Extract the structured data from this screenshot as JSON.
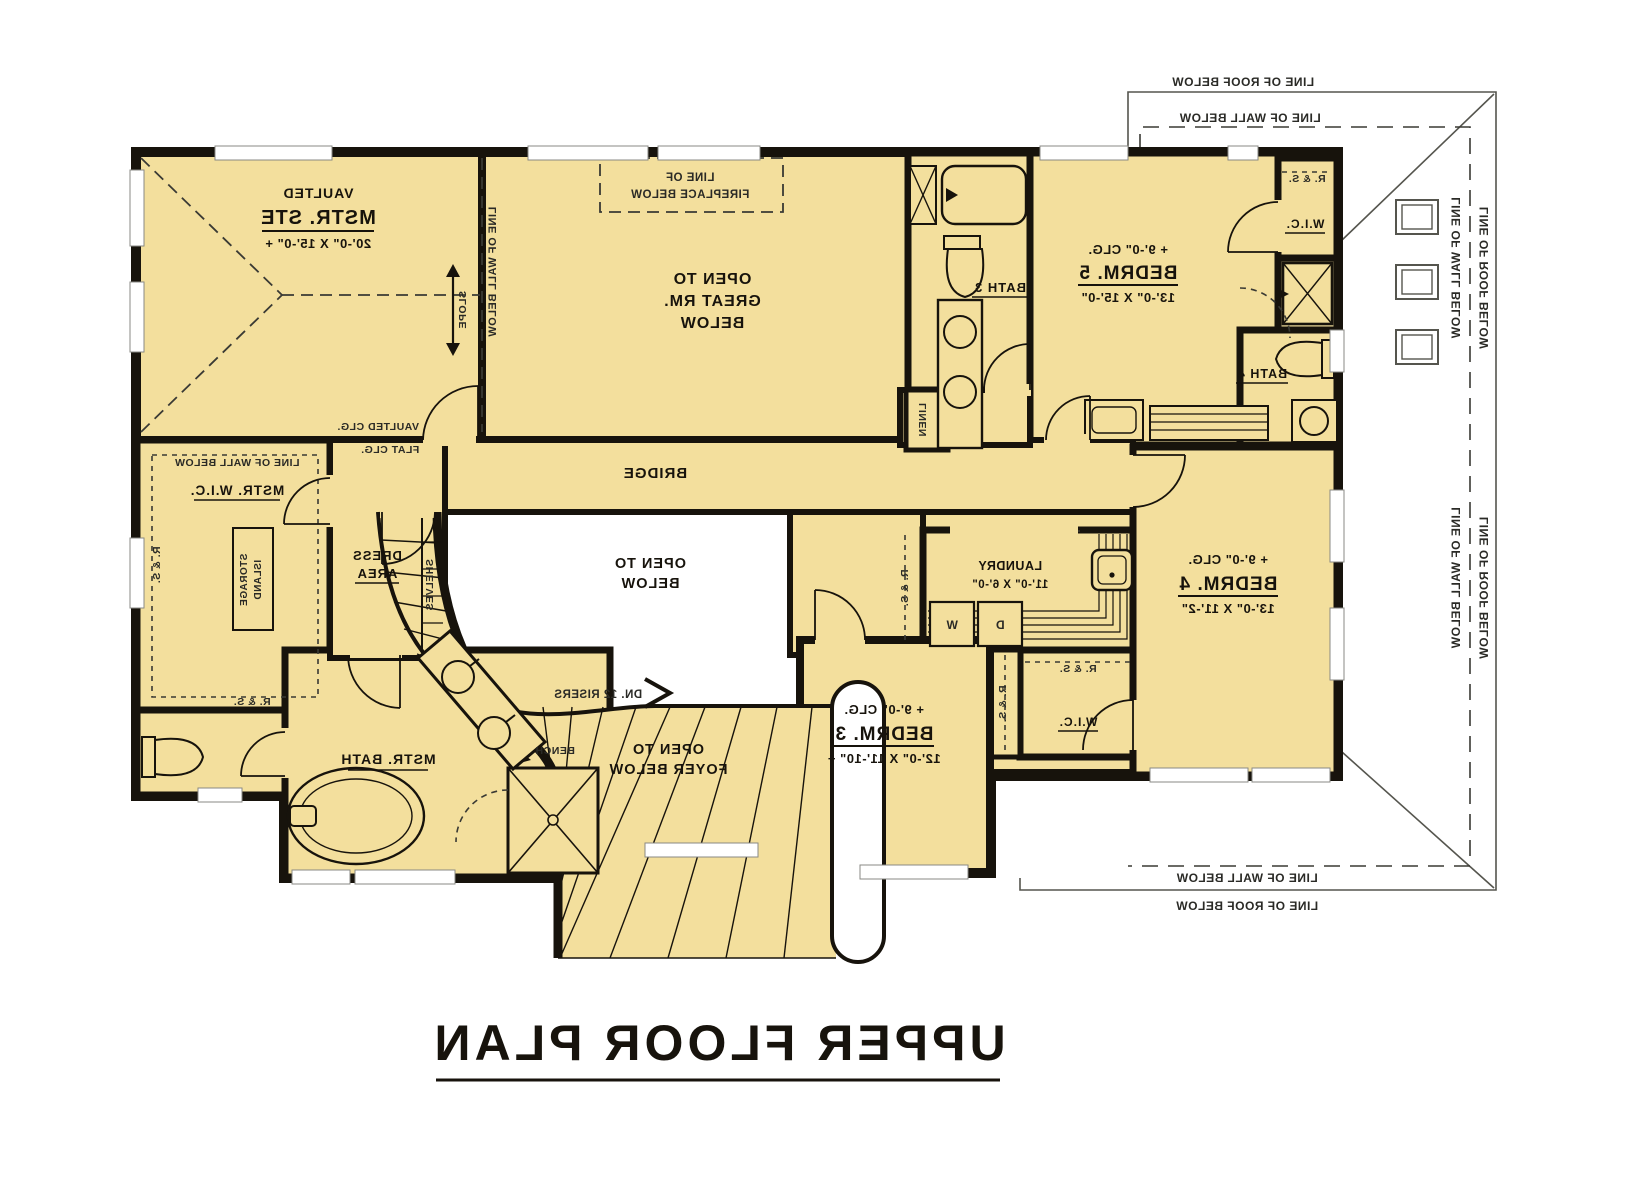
{
  "title": "UPPER FLOOR PLAN",
  "rooms": {
    "mstr_ste": {
      "tag": "VAULTED",
      "name": "MSTR. STE",
      "dims": "20'-0\" X 15'-0\" +"
    },
    "great_rm": {
      "l1": "OPEN TO",
      "l2": "GREAT RM.",
      "l3": "BELOW"
    },
    "bridge": {
      "name": "BRIDGE"
    },
    "open_below": {
      "l1": "OPEN TO",
      "l2": "BELOW"
    },
    "open_foyer": {
      "l1": "OPEN TO",
      "l2": "FOYER BELOW"
    },
    "bath3": {
      "name": "BATH 3"
    },
    "bath4": {
      "name": "BATH 4"
    },
    "bedrm5": {
      "clg": "+ 9'-0\" CLG.",
      "name": "BEDRM. 5",
      "dims": "13'-0\" X 15'-0\""
    },
    "bedrm4": {
      "clg": "+ 9'-0\" CLG.",
      "name": "BEDRM. 4",
      "dims": "13'-0\" X 11'-2\""
    },
    "bedrm3": {
      "clg": "+ 9'-0\" CLG.",
      "name": "BEDRM. 3",
      "dims": "12'-0\" X 11'-10\" +"
    },
    "laundry": {
      "name": "LAUNDRY",
      "dims": "11'-0\" X 6'-0\""
    },
    "mstr_wic": {
      "name": "MSTR. W.I.C."
    },
    "mstr_bath": {
      "name": "MSTR. BATH"
    },
    "dress": {
      "l1": "DRESS",
      "l2": "AREA"
    },
    "wic": {
      "name": "W.I.C."
    }
  },
  "fixtures": {
    "washer": "W",
    "dryer": "D",
    "bench": "BENCH",
    "linen": "LINEN",
    "shelves": "SHELVES",
    "storage1": "STORAGE",
    "storage2": "ISLAND",
    "rs": "R. & S."
  },
  "annotations": {
    "wall_below": "LINE OF WALL BELOW",
    "roof_below": "LINE OF ROOF BELOW",
    "canopy": "LINE OF CANOPY ROOF BELOW",
    "fireplace1": "LINE OF",
    "fireplace2": "FIREPLACE BELOW",
    "vaulted_clg": "VAULTED CLG.",
    "flat_clg": "FLAT CLG.",
    "slope": "SLOPE",
    "down": "DN. 12 RISERS"
  },
  "colors": {
    "floor": "#F3DF9D",
    "wall": "#17130C",
    "background": "#FFFFFF",
    "dash": "#3A3A34"
  }
}
